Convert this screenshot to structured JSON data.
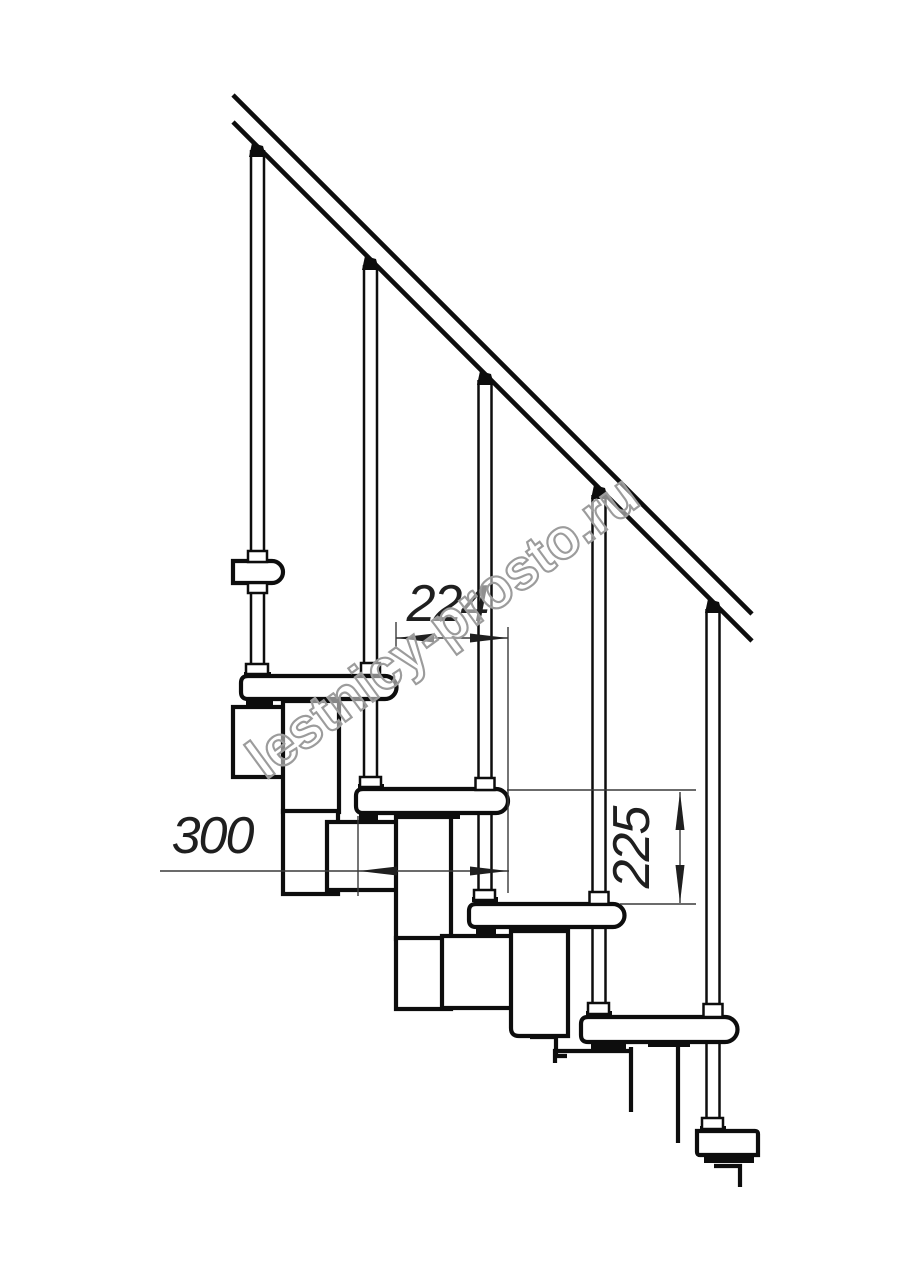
{
  "drawing": {
    "type": "staircase-side-elevation-technical-drawing",
    "background": "#ffffff",
    "line_color": "#0d0d0d",
    "dimension_line_color": "#3a3a3a",
    "watermark": {
      "text": "lestnicy-prosto.ru",
      "color": "#9c9c9c",
      "angle_deg": -36.3
    },
    "dimensions": {
      "going": {
        "value": "224",
        "orientation": "horizontal"
      },
      "tread_depth": {
        "value": "300",
        "orientation": "horizontal"
      },
      "rise": {
        "value": "225",
        "orientation": "vertical"
      }
    },
    "structure": {
      "balusters_visible": 5,
      "treads_visible": 5,
      "handrail_slope_deg": 45
    }
  }
}
